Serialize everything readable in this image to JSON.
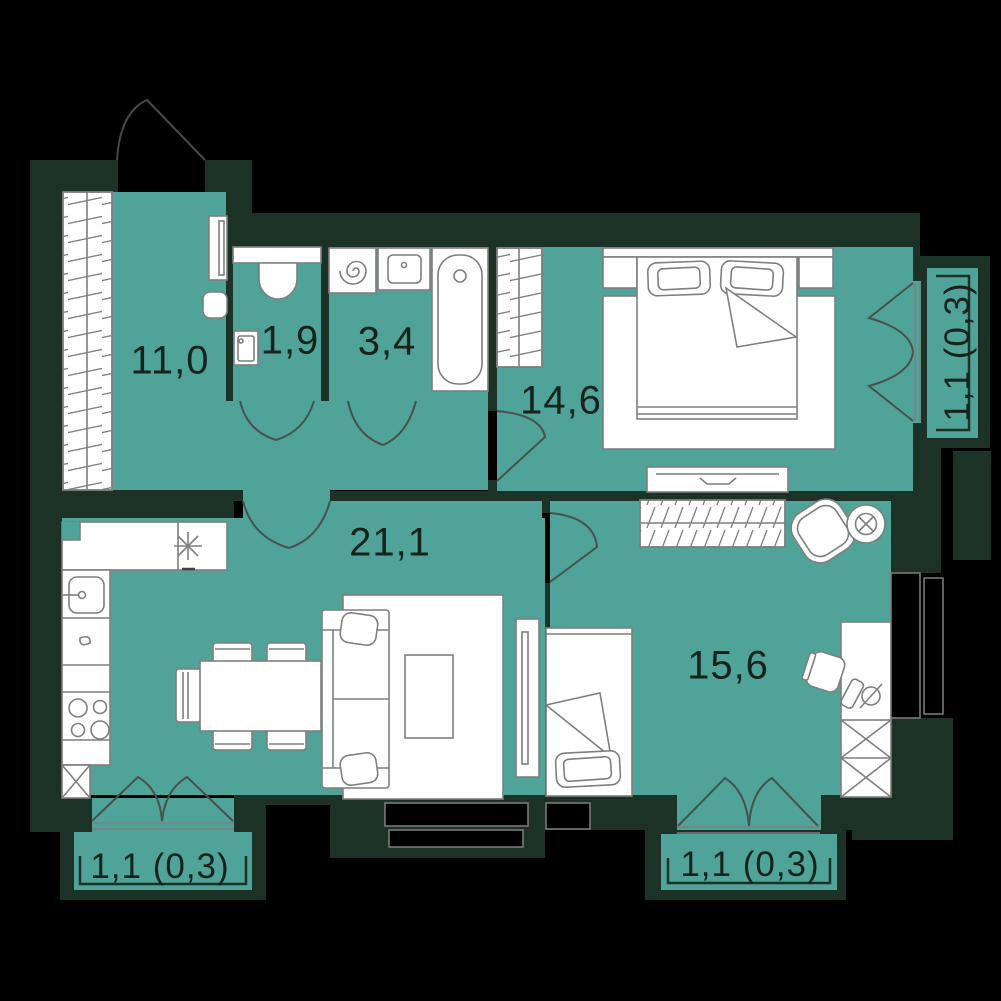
{
  "plan_title": "apartment-floor-plan",
  "rooms": [
    {
      "id": "hallway",
      "area": "11,0"
    },
    {
      "id": "wc",
      "area": "1,9"
    },
    {
      "id": "bathroom",
      "area": "3,4"
    },
    {
      "id": "bedroom",
      "area": "14,6"
    },
    {
      "id": "kitchen-living",
      "area": "21,1"
    },
    {
      "id": "bedroom-2",
      "area": "15,6"
    }
  ],
  "balconies": [
    {
      "id": "balcony-bottom-left",
      "area": "1,1 (0,3)"
    },
    {
      "id": "balcony-bottom-right",
      "area": "1,1 (0,3)"
    },
    {
      "id": "balcony-right",
      "area": "1,1 (0,3)"
    }
  ],
  "icons": [
    "entrance-door",
    "hall-wardrobe",
    "mirror",
    "pouf",
    "toilet",
    "wc-sink",
    "washing-machine",
    "bath-sink",
    "bathtub",
    "bedroom-wardrobe",
    "double-bed",
    "nightstand",
    "rug",
    "tv-console",
    "kitchen-counter",
    "fridge",
    "kitchen-sink",
    "stove",
    "dining-table",
    "chair",
    "sofa",
    "coffee-table",
    "tv",
    "shelf",
    "armchair",
    "floor-lamp",
    "single-bed",
    "desk",
    "desk-lamp",
    "office-chair",
    "wardrobe-x",
    "window",
    "balcony-door",
    "interior-door"
  ],
  "colors": {
    "background": "#000000",
    "wall": "#1d3226",
    "floor": "#4fa399",
    "fixture_fill": "#ffffff",
    "furniture_outline": "#7f7f7f",
    "label_text": "#15231b"
  }
}
